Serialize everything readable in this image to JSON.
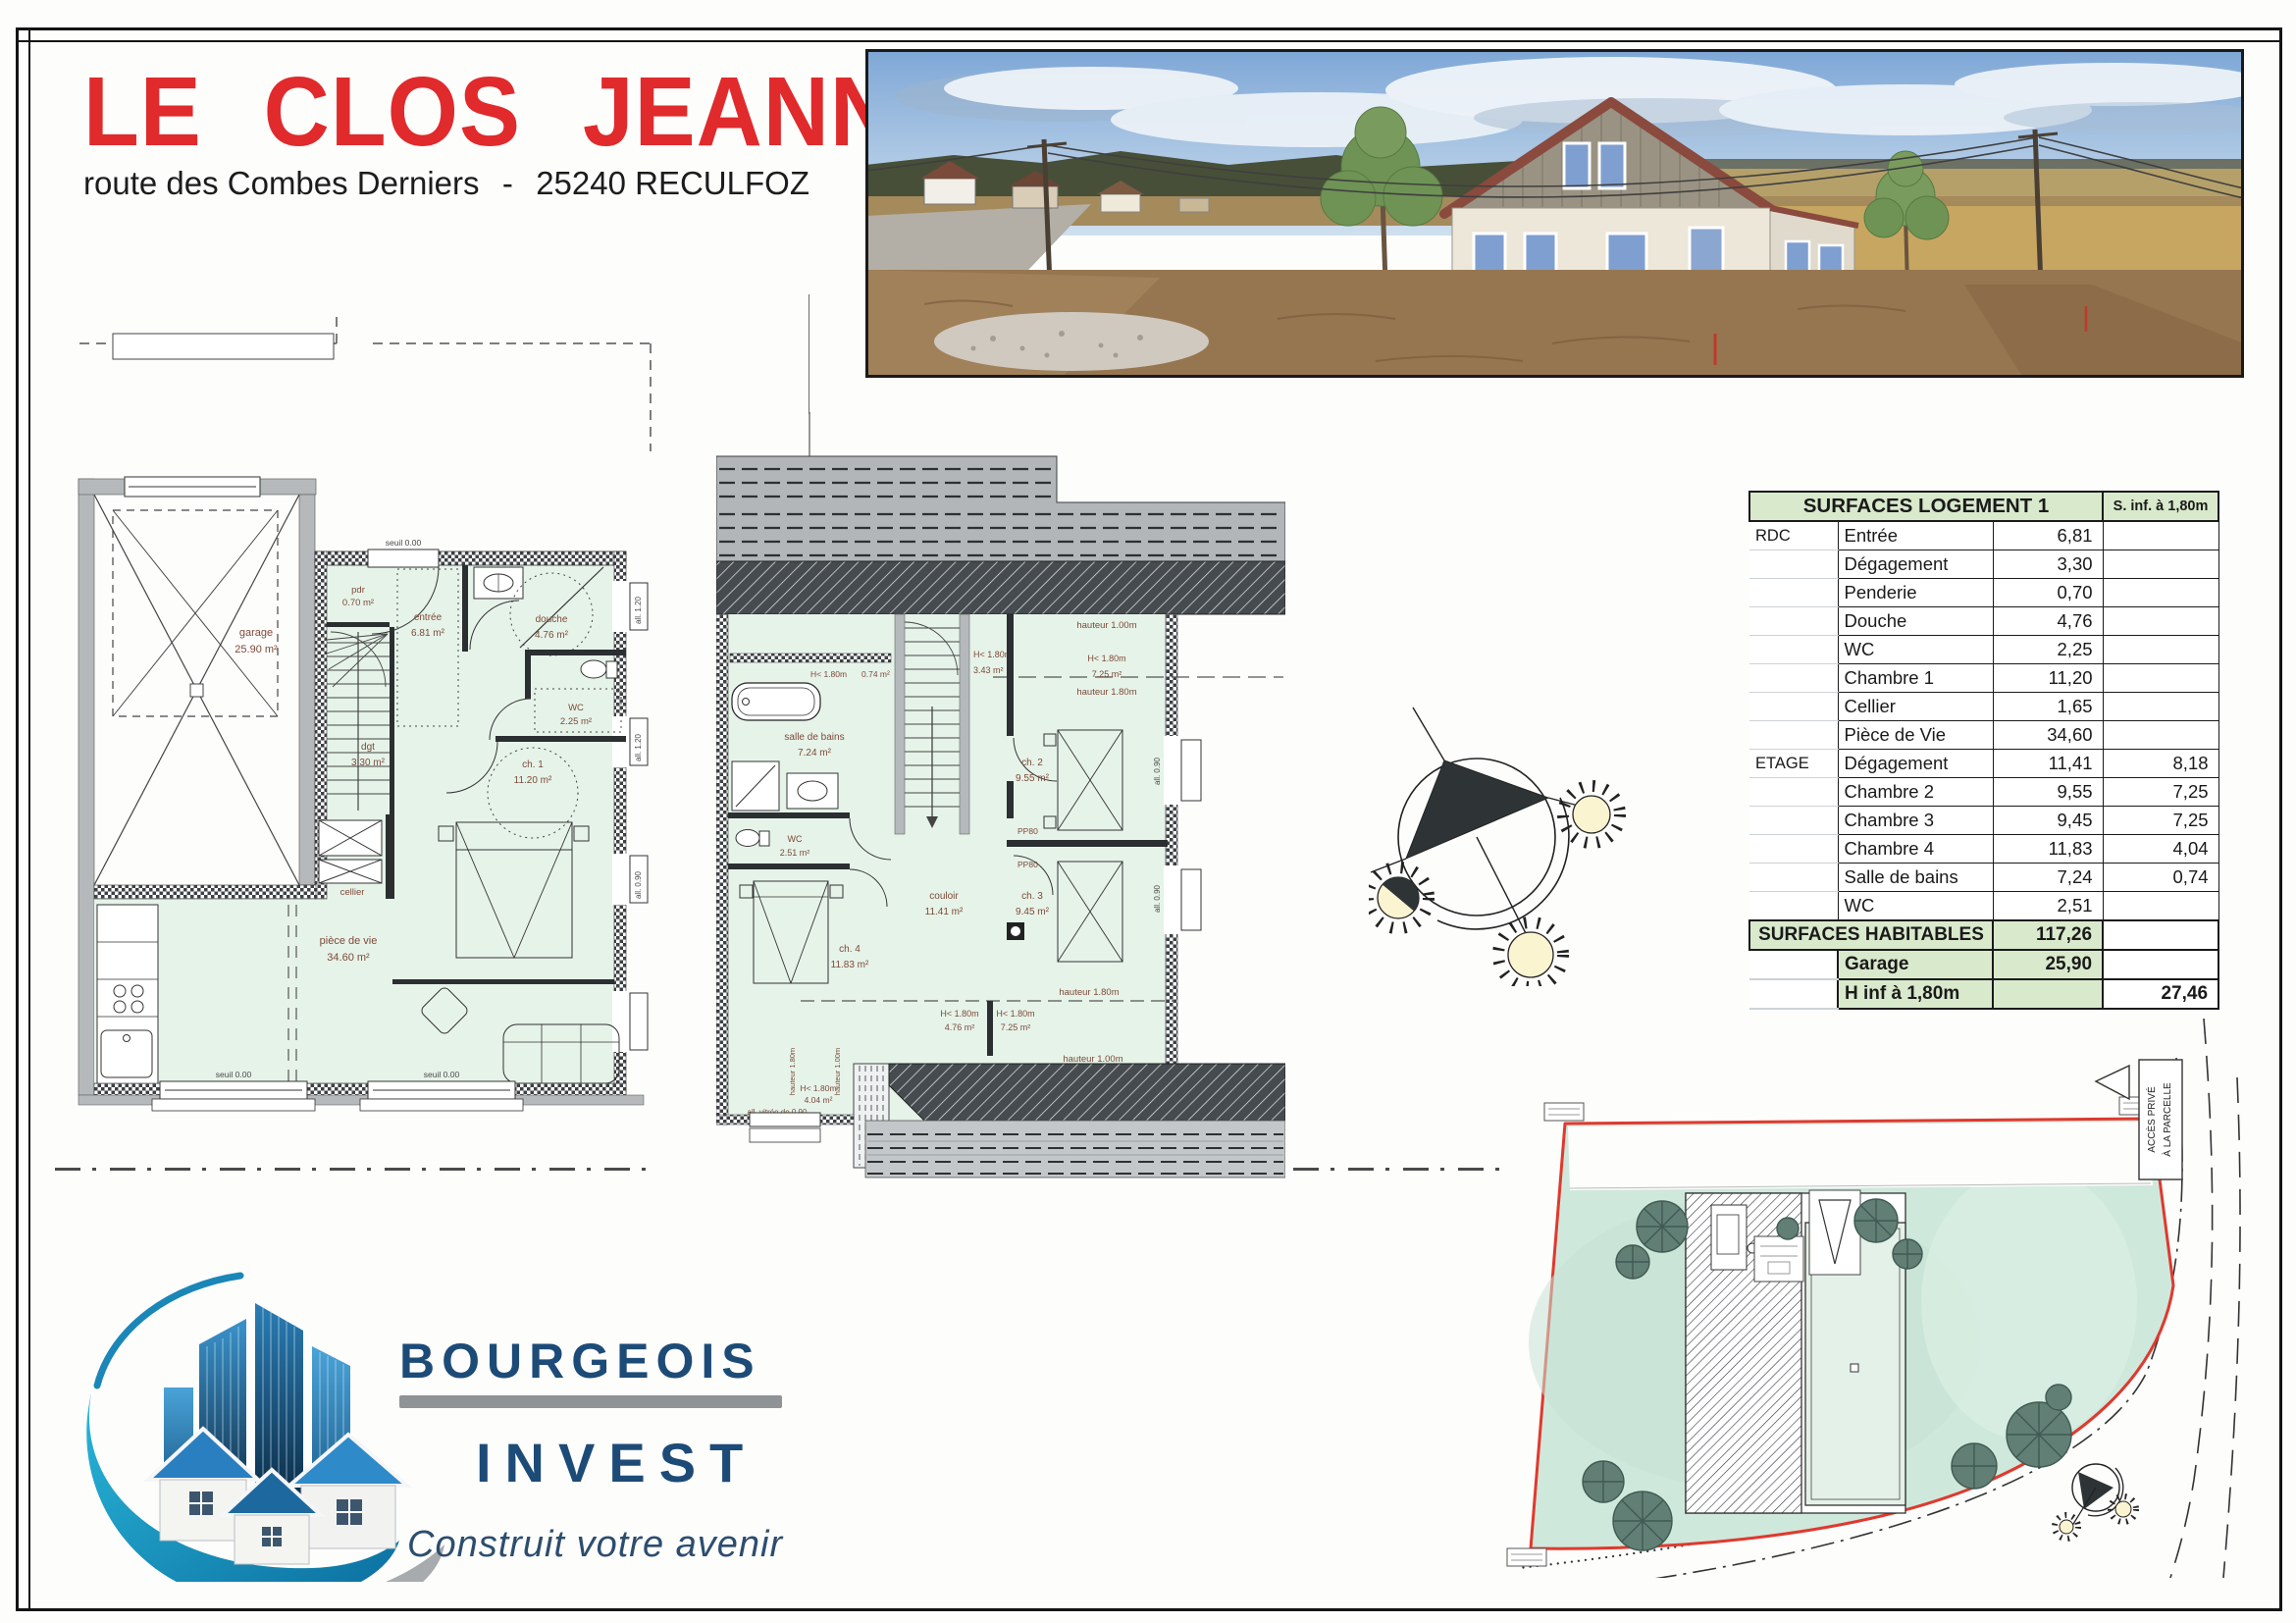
{
  "header": {
    "title": "LE CLOS JEANNE",
    "address_street": "route des Combes Derniers",
    "address_separator": "-",
    "address_city": "25240 RECULFOZ"
  },
  "surfaces_table": {
    "title": "SURFACES LOGEMENT 1",
    "sinf_header": "S. inf. à 1,80m",
    "rows": [
      {
        "floor": "RDC",
        "room": "Entrée",
        "value": "6,81",
        "sinf": ""
      },
      {
        "floor": "",
        "room": "Dégagement",
        "value": "3,30",
        "sinf": ""
      },
      {
        "floor": "",
        "room": "Penderie",
        "value": "0,70",
        "sinf": ""
      },
      {
        "floor": "",
        "room": "Douche",
        "value": "4,76",
        "sinf": ""
      },
      {
        "floor": "",
        "room": "WC",
        "value": "2,25",
        "sinf": ""
      },
      {
        "floor": "",
        "room": "Chambre 1",
        "value": "11,20",
        "sinf": ""
      },
      {
        "floor": "",
        "room": "Cellier",
        "value": "1,65",
        "sinf": ""
      },
      {
        "floor": "",
        "room": "Pièce de Vie",
        "value": "34,60",
        "sinf": ""
      },
      {
        "floor": "ETAGE",
        "room": "Dégagement",
        "value": "11,41",
        "sinf": "8,18"
      },
      {
        "floor": "",
        "room": "Chambre 2",
        "value": "9,55",
        "sinf": "7,25"
      },
      {
        "floor": "",
        "room": "Chambre 3",
        "value": "9,45",
        "sinf": "7,25"
      },
      {
        "floor": "",
        "room": "Chambre 4",
        "value": "11,83",
        "sinf": "4,04"
      },
      {
        "floor": "",
        "room": "Salle de bains",
        "value": "7,24",
        "sinf": "0,74"
      },
      {
        "floor": "",
        "room": "WC",
        "value": "2,51",
        "sinf": ""
      }
    ],
    "totals": {
      "habitables_label": "SURFACES HABITABLES",
      "habitables_value": "117,26",
      "garage_label": "Garage",
      "garage_value": "25,90",
      "hinf_label": "H inf à 1,80m",
      "hinf_sinf": "27,46"
    }
  },
  "rdc_plan": {
    "garage_name": "garage",
    "garage_area": "25.90 m²",
    "pdr_name": "pdr",
    "pdr_area": "0.70 m²",
    "entree_name": "entrée",
    "entree_area": "6.81 m²",
    "douche_name": "douche",
    "douche_area": "4.76 m²",
    "wc_name": "WC",
    "wc_area": "2.25 m²",
    "dgt_name": "dgt",
    "dgt_area": "3.30 m²",
    "ch1_name": "ch. 1",
    "ch1_area": "11.20 m²",
    "cellier_name": "cellier",
    "piece_name": "pièce de vie",
    "piece_area": "34.60 m²",
    "seuil": "seuil 0.00",
    "all_120": "all. 1.20",
    "all_090": "all. 0.90"
  },
  "etage_plan": {
    "sdb_name": "salle de bains",
    "sdb_area": "7.24 m²",
    "wc_name": "WC",
    "wc_area": "2.51 m²",
    "ch4_name": "ch. 4",
    "ch4_area": "11.83 m²",
    "couloir_name": "couloir",
    "couloir_area": "11.41 m²",
    "ch2_name": "ch. 2",
    "ch2_area": "9.55 m²",
    "ch3_name": "ch. 3",
    "ch3_area": "9.45 m²",
    "h_lt": "H< 1.80m",
    "a_074": "0.74 m²",
    "a_343": "3.43 m²",
    "a_725": "7.25 m²",
    "a_476": "4.76 m²",
    "a_404": "4.04 m²",
    "hauteur_100": "hauteur 1.00m",
    "hauteur_180": "hauteur 1.80m",
    "pp80": "PP80",
    "all_vitree": "all. vitrée de 0.90",
    "all_090": "all. 0.90"
  },
  "site_plan": {
    "access_line1": "ACCÈS PRIVÉ",
    "access_line2": "À LA PARCELLE"
  },
  "logo": {
    "name_top": "BOURGEOIS",
    "name_bottom": "INVEST",
    "tagline": "Construit votre avenir"
  },
  "colors": {
    "title_red": "#e02a2c",
    "table_green": "#d9e9cc",
    "plan_green": "#e6f3e9",
    "parcel_green": "#cfe8dc",
    "parcel_border_red": "#e0392e",
    "logo_navy": "#1d4b77",
    "logo_blue": "#2a7ab2",
    "logo_teal": "#0f85b5",
    "label_brown": "#7d4a38"
  }
}
